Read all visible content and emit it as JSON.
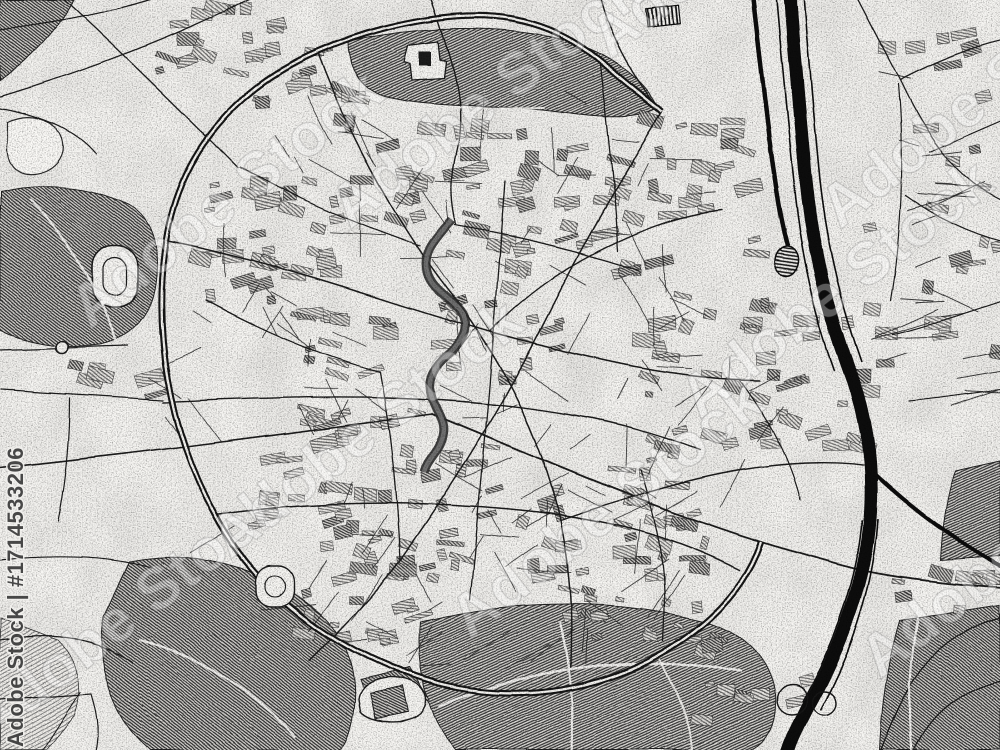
{
  "stock_preview": {
    "watermark_id_label": "Adobe Stock | #1714533206",
    "watermark_tile_label": "Adobe Stock"
  },
  "palette": {
    "background": "#f7f6f3",
    "ink": "#1a1a1a",
    "hatch_dark": "#383838",
    "hatch_mid": "#555555",
    "water_gray": "#6f6f6f",
    "watermark_text": "#3b3b3b",
    "watermark_halo": "#f2f1ee"
  },
  "map": {
    "style": "Greyscale pencil-sketch city street map with ring road, railway corridor and river",
    "features": [
      "ring-road",
      "railway-corridor",
      "railway-station",
      "river",
      "city-park",
      "west-forest",
      "stadium",
      "south-woods",
      "pond",
      "urban-blocks",
      "street-network"
    ]
  }
}
